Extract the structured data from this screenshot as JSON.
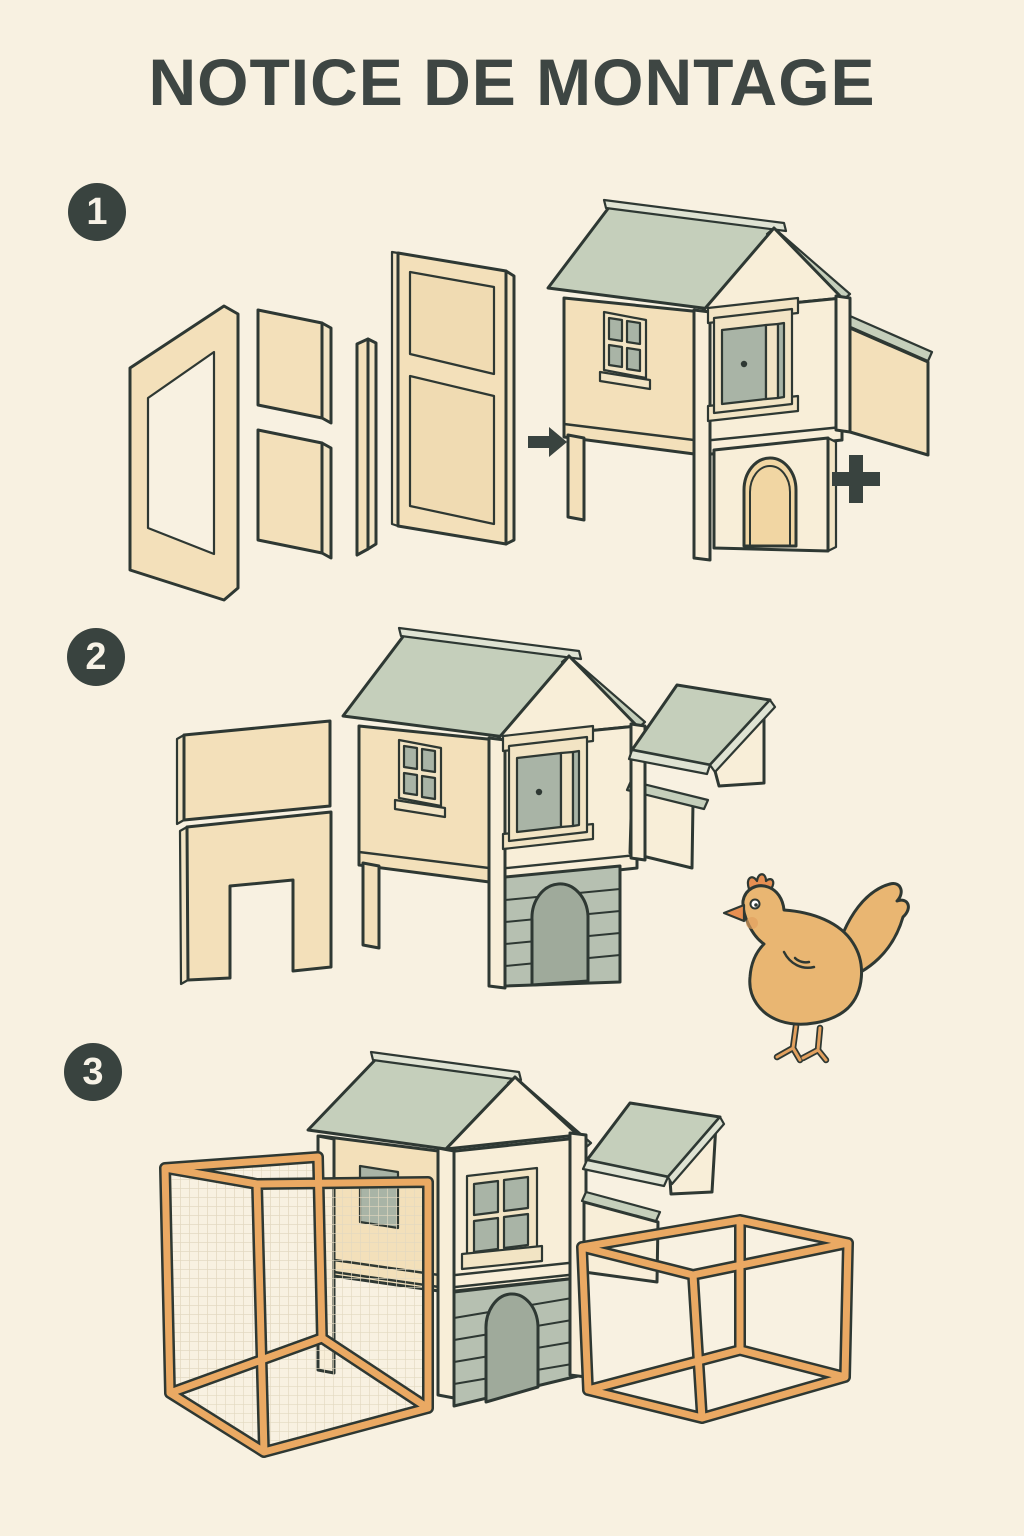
{
  "title": "NOTICE DE MONTAGE",
  "steps": [
    {
      "number": "1"
    },
    {
      "number": "2"
    },
    {
      "number": "3"
    }
  ],
  "illustrations": {
    "step1": {
      "parts": [
        "side-frame-panel",
        "upper-square-panel",
        "lower-square-panel",
        "corner-post",
        "door-frame-panel"
      ],
      "symbols": [
        "right-arrow",
        "plus-sign"
      ],
      "result": "coop-body-on-stilts-with-nesting-box"
    },
    "step2": {
      "parts": [
        "back-panel",
        "doorway-panel",
        "nesting-box-roof"
      ],
      "result": "coop-with-detached-nesting-box-roof",
      "mascot": "hen"
    },
    "step3": {
      "parts": [
        "left-mesh-run",
        "right-run-frame"
      ],
      "result": "complete-coop-with-runs"
    }
  },
  "colors": {
    "bg": "#f8f1e1",
    "title": "#3e4643",
    "badge": "#39433f",
    "badgeText": "#f7f2e6",
    "outline": "#2e3833",
    "panel": "#f3e0ba",
    "panelLight": "#f8eed8",
    "panelEdge": "#f2e4c4",
    "insetBeige": "#f0dbb2",
    "roof": "#c5cfbb",
    "roofLight": "#dfe3d3",
    "windowGray": "#a9b4a6",
    "grayPanel": "#b6c0b1",
    "grayPanelDark": "#9faa9b",
    "doorTan": "#f1d6a3",
    "orange": "#eaa963",
    "mesh": "#e2d8c0",
    "hen": "#e9b672",
    "henAccent": "#e2a05e",
    "henComb": "#e78f52",
    "symbol": "#39433f"
  }
}
